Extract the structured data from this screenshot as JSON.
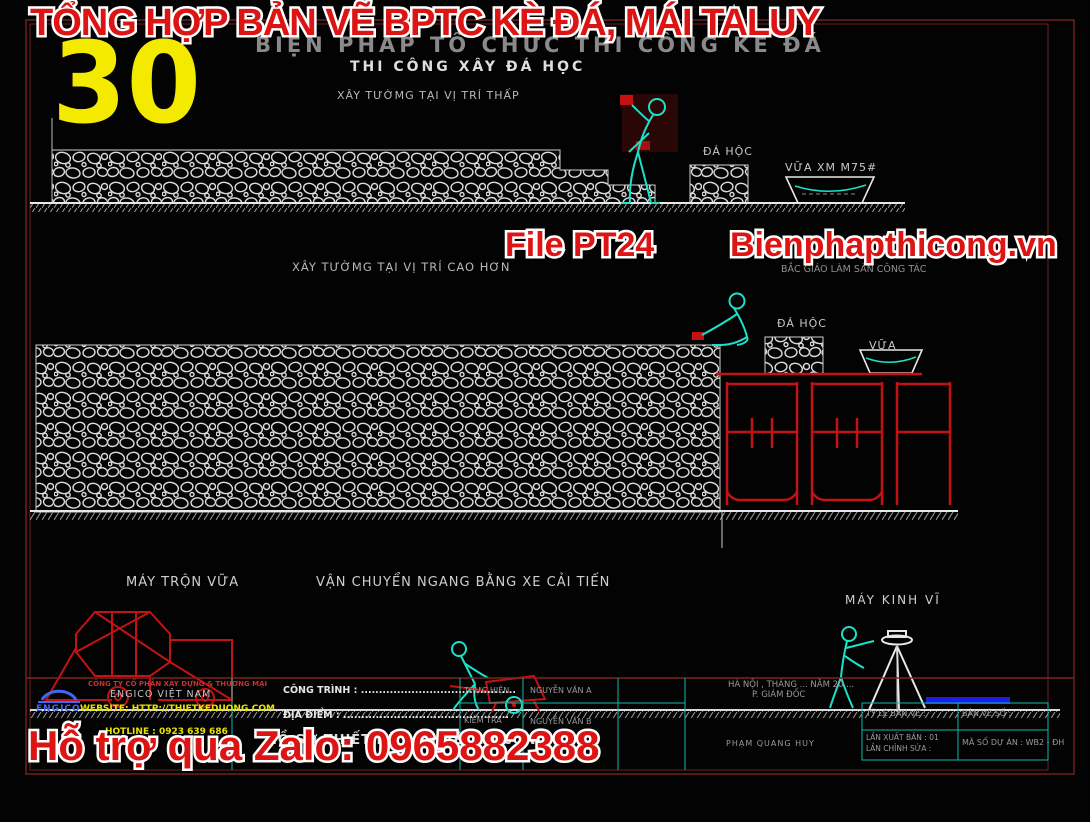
{
  "overlay": {
    "top_title": "TỔNG HỢP BẢN VẼ BPTC KÈ ĐÁ, MÁI TALUY",
    "sheet_number": "30",
    "file_label": "File PT24",
    "site": "Bienphapthicong.vn",
    "zalo": "Hỗ trợ qua Zalo: 0965882388"
  },
  "sheet": {
    "main_title": "BIỆN PHÁP TỔ CHỨC THI CÔNG KÈ ĐÁ",
    "sub_title": "THI CÔNG XÂY ĐÁ HỌC",
    "low_wall": {
      "caption": "XÂY TƯỜMG TẠI VỊ TRÍ THẤP",
      "stone": "ĐÁ HỘC",
      "mortar": "VỮA XM M75#"
    },
    "high_wall": {
      "caption": "XÂY TƯỜMG TẠI VỊ TRÍ CAO HƠN",
      "scaffold": "BẮC GIÁO LÀM SÀN CÔNG TÁC",
      "stone": "ĐÁ HỘC",
      "mortar": "VỮA"
    },
    "equipment": {
      "mixer": "MÁY TRỘN VỮA",
      "cart": "VẬN CHUYỂN NGANG BẰNG XE CẢI TIẾN",
      "theodolite": "MÁY KINH VĨ"
    }
  },
  "titleblock": {
    "logo_text": "ENGICO",
    "company_line1": "CÔNG TY CỔ PHẦN XÂY DỰNG & THƯƠNG MẠI",
    "company_line2": "ENGICO VIỆT NAM",
    "website": "WEBSITE: HTTP://THIETKEDUONG.COM",
    "hotline": "HOTLINE : 0923 639 686",
    "project": "CÔNG TRÌNH : ...........................................",
    "location": "ĐỊA ĐIỂM : ..............................................",
    "doc_title": "HỒ SƠ THIẾT KẾ BẢN VẼ THI CÔNG",
    "role1": "THỰC HIỆN",
    "name1": "NGUYỄN VĂN A",
    "role2": "KIỂM TRA",
    "name2": "NGUYỄN VĂN B",
    "place_date": "HÀ NỘI , THÁNG ... NĂM 20 ...",
    "signer_title": "P. GIÁM ĐỐC",
    "signer_name": "PHẠM QUANG HUY",
    "scale": "TỶ LỆ BẢN VẼ :",
    "drawing_no": "BẢN VẼ SỐ :",
    "edition": "LẦN XUẤT BẢN : 01",
    "revision": "LẦN CHỈNH SỬA :",
    "project_code": "MÃ SỐ DỰ ÁN : WB2 - ĐH"
  },
  "colors": {
    "overlay_red": "#dd1414",
    "highlight_yellow": "#f4ea00",
    "cad_cyan": "#1ce0c8",
    "scaffold_red": "#c41212",
    "teal_line": "#0fb8a8",
    "blue_bar": "#1d1dee"
  }
}
